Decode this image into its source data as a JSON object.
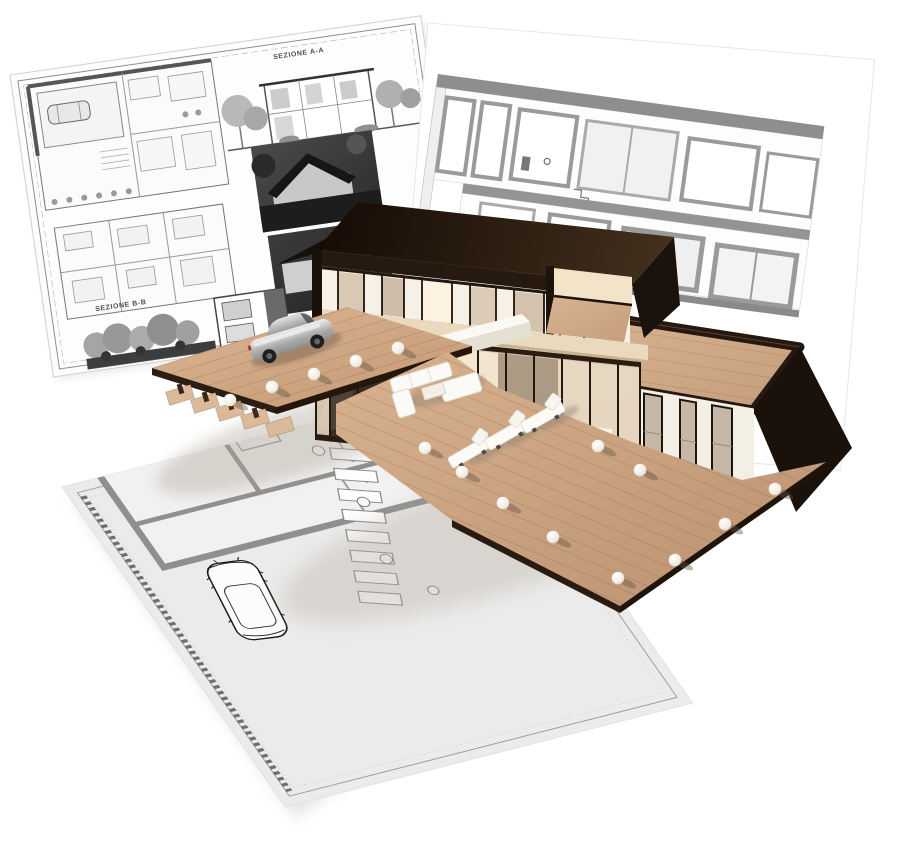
{
  "page": {
    "background": "#ffffff",
    "subject": "3D architectural visualization of a modern two-storey villa standing on printed blueprint sheets"
  },
  "sheets": {
    "left": {
      "section_a_label": "SEZIONE A-A",
      "section_b_label": "SEZIONE B-B",
      "contents": [
        "ground floor plan",
        "first floor plan",
        "section A-A drawing",
        "section B-B drawing",
        "grayscale exterior render 1",
        "grayscale exterior render 2"
      ],
      "paper_color": "#fdfdfd",
      "ink_color": "#6f6f6f"
    },
    "right": {
      "contents": [
        "building cross-section elevation with windows, stair and roof slab"
      ],
      "paper_color": "#ffffff",
      "ink_color": "#929292"
    },
    "bottom": {
      "contents": [
        "site floor plan with thick walls, sketched car, stepping pavers, planting circles, sawtooth boundary hatch"
      ],
      "paper_color": "#f0f0f0",
      "ink_color": "#8a8a8a"
    }
  },
  "model": {
    "storeys": 2,
    "colors": {
      "roof_dark_brown": "#241711",
      "wall_white": "#f5f1e8",
      "glass_warm": "#d6c7b4",
      "deck_wood": "#cda988",
      "slab_cream": "#ead9bd",
      "accent_dark": "#1b120b"
    },
    "objects": {
      "car_3d": "silver hatchback on wooden driveway deck",
      "car_sketch": "top-view sketched car on site plan",
      "lounge_chairs": 3,
      "sofa_set": "white outdoor sofa set with coffee table",
      "sphere_lights": 15
    }
  }
}
